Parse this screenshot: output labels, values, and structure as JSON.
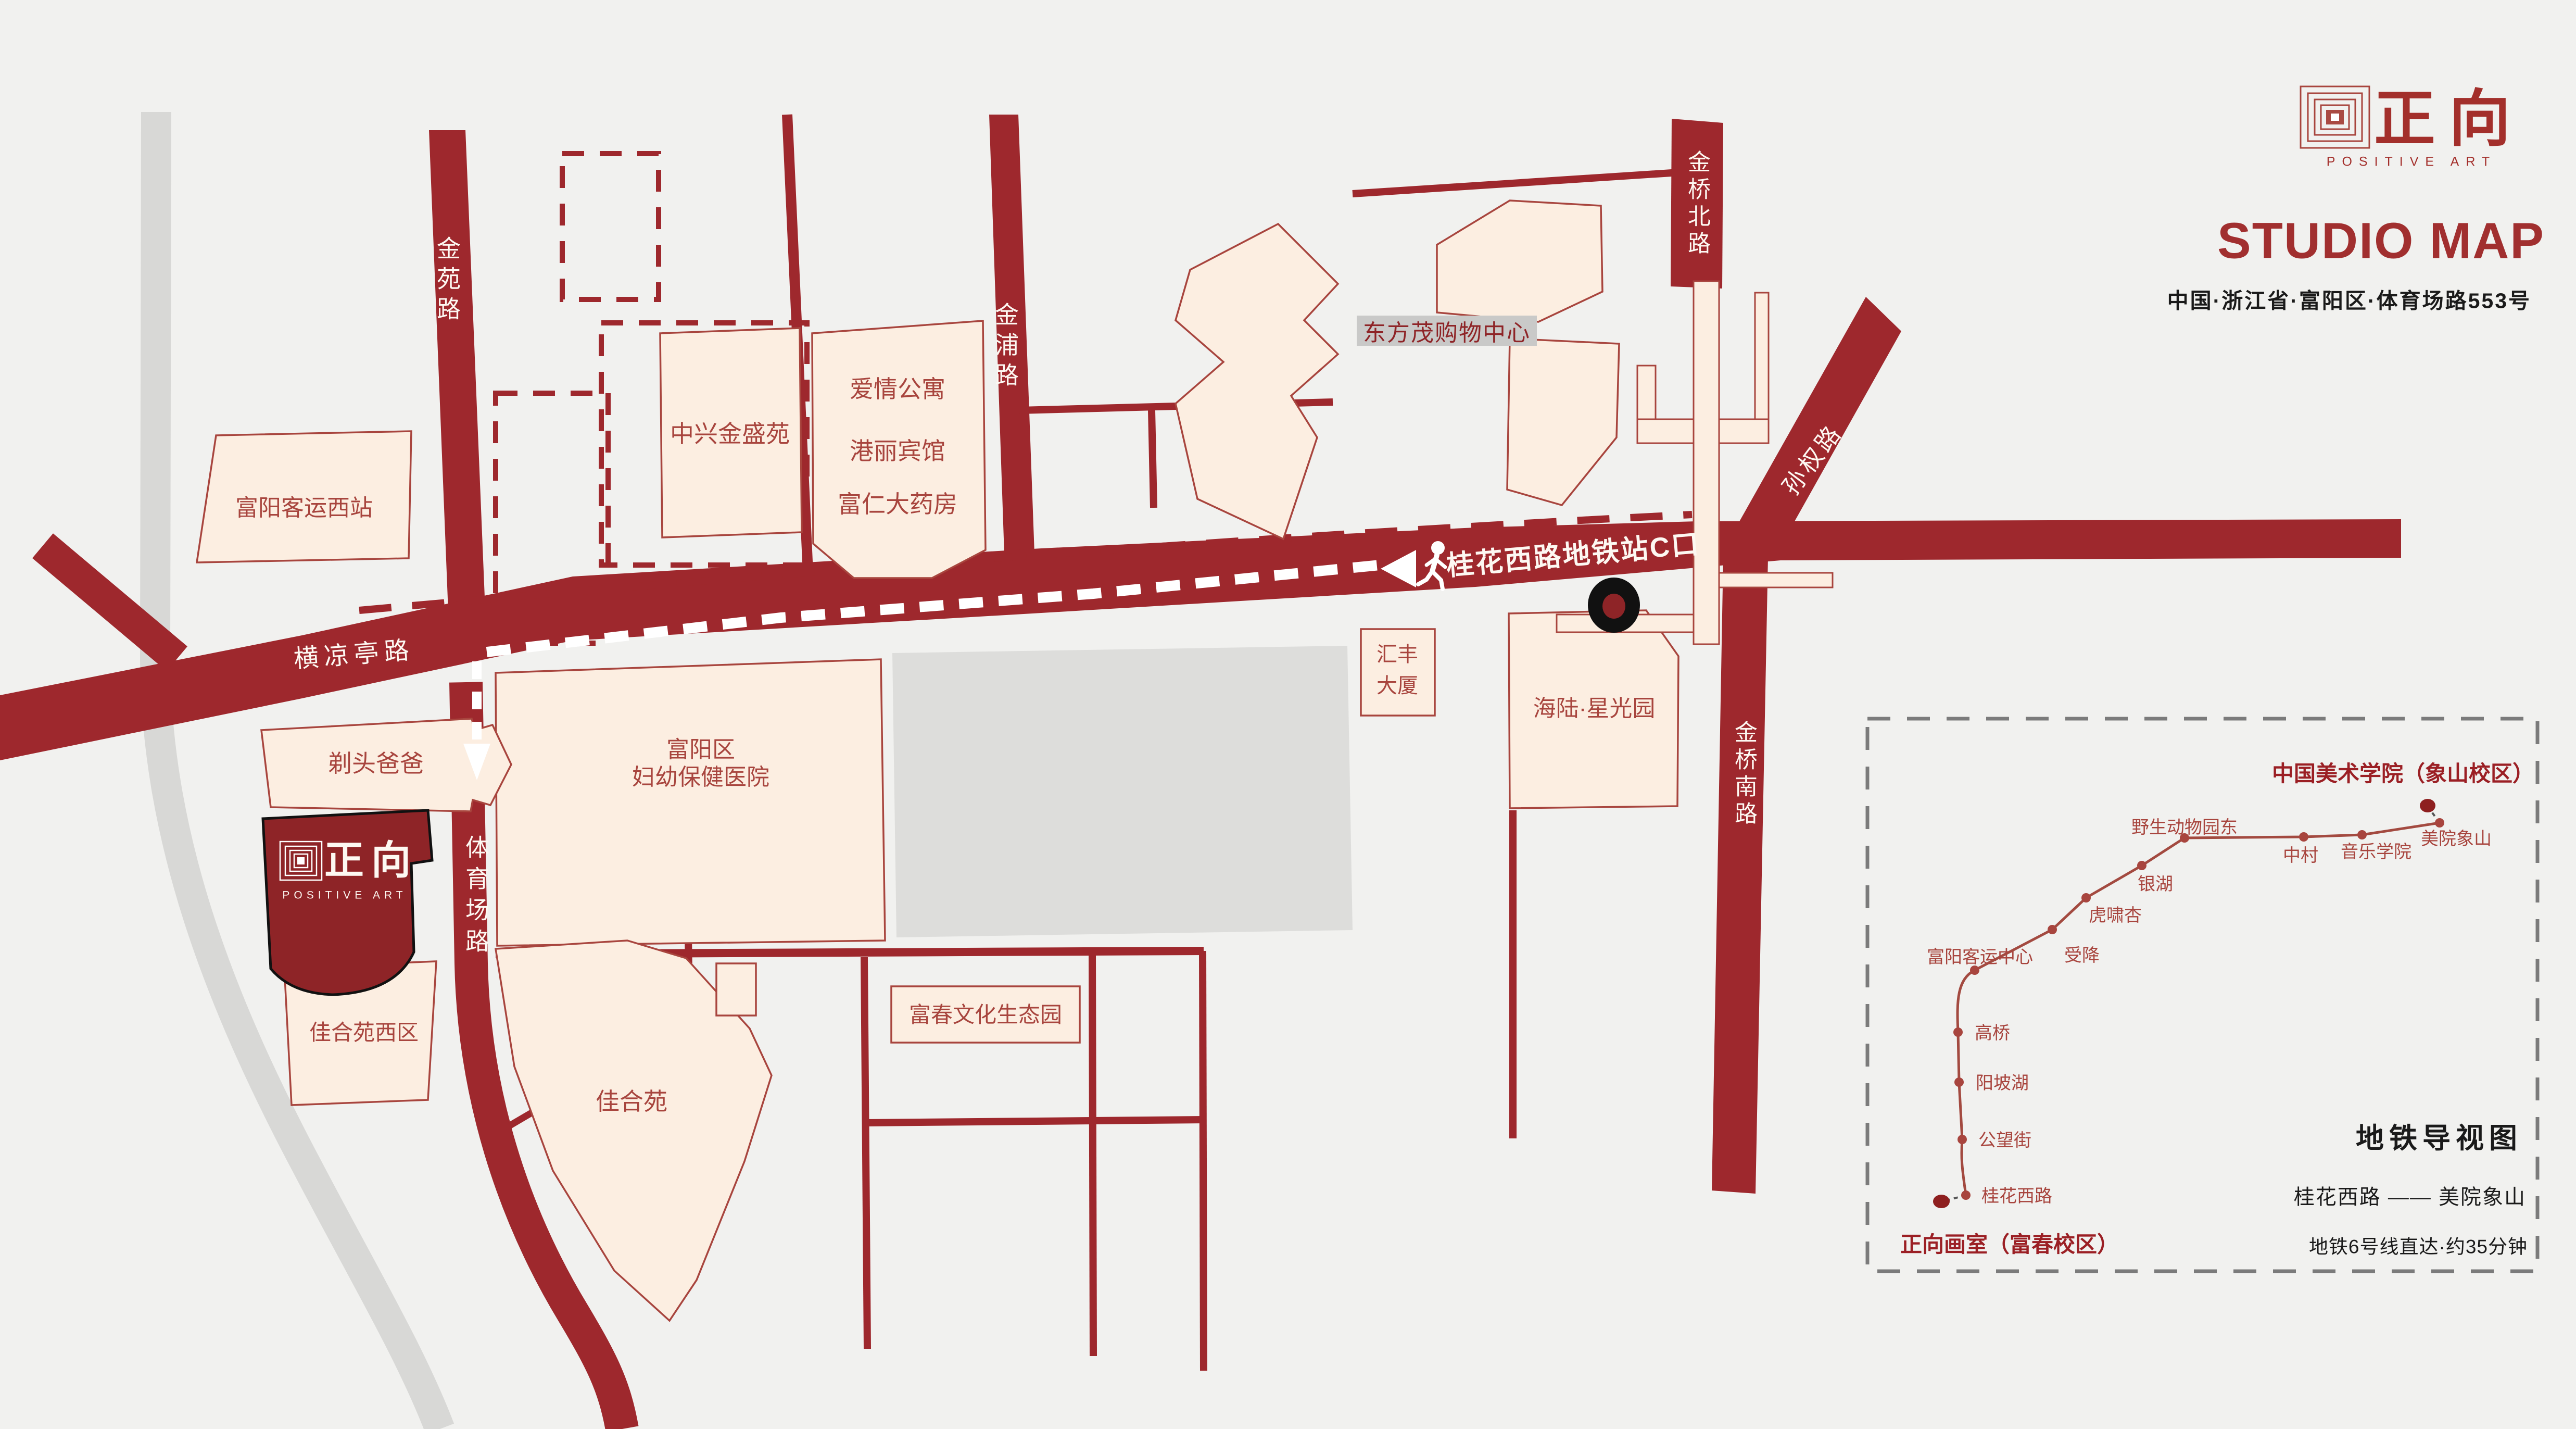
{
  "header": {
    "brand_cn": "正向",
    "brand_en": "POSITIVE ART",
    "title": "STUDIO MAP",
    "address": "中国·浙江省·富阳区·体育场路553号"
  },
  "roads": {
    "jinyuan": "金苑路",
    "jinpu": "金浦路",
    "jinqiao_north": "金桥北路",
    "jinqiao_south": "金桥南路",
    "sunquan": "孙权路",
    "hengliangting": "横凉亭路",
    "tiyuchang": "体育场路"
  },
  "route": {
    "station_exit_label": "桂花西路地铁站C口"
  },
  "places": {
    "bus_station_west": "富阳客运西站",
    "zhongxing": "中兴金盛苑",
    "apartment": "爱情公寓",
    "hotel": "港丽宾馆",
    "pharmacy": "富仁大药房",
    "mall": "东方茂购物中心",
    "huifeng_l1": "汇丰",
    "huifeng_l2": "大厦",
    "hailu": "海陆·星光园",
    "hospital_l1": "富阳区",
    "hospital_l2": "妇幼保健医院",
    "barber": "剃头爸爸",
    "jiahe_west": "佳合苑西区",
    "jiahe": "佳合苑",
    "fuchun_park": "富春文化生态园"
  },
  "studio": {
    "brand_cn": "正向",
    "brand_en": "POSITIVE ART"
  },
  "inset": {
    "title": "地铁导视图",
    "route_line": "桂花西路 —— 美院象山",
    "note": "地铁6号线直达·约35分钟",
    "endpoint_top": "中国美术学院（象山校区）",
    "endpoint_bottom": "正向画室（富春校区）",
    "stations": [
      {
        "name": "桂花西路"
      },
      {
        "name": "公望街"
      },
      {
        "name": "阳坡湖"
      },
      {
        "name": "高桥"
      },
      {
        "name": "富阳客运中心"
      },
      {
        "name": "受降"
      },
      {
        "name": "虎啸杏"
      },
      {
        "name": "银湖"
      },
      {
        "name": "野生动物园东"
      },
      {
        "name": "中村"
      },
      {
        "name": "音乐学院"
      },
      {
        "name": "美院象山"
      }
    ]
  },
  "colors": {
    "road_red": "#9E282D",
    "studio_red": "#8E2427",
    "building_fill": "#FCEEE1",
    "building_stroke": "#A8453E",
    "metro_line": "#A34A40",
    "terminal_dot": "#8E1F1F",
    "gray_road": "#D8D8D6",
    "background": "#F1F1EF"
  }
}
